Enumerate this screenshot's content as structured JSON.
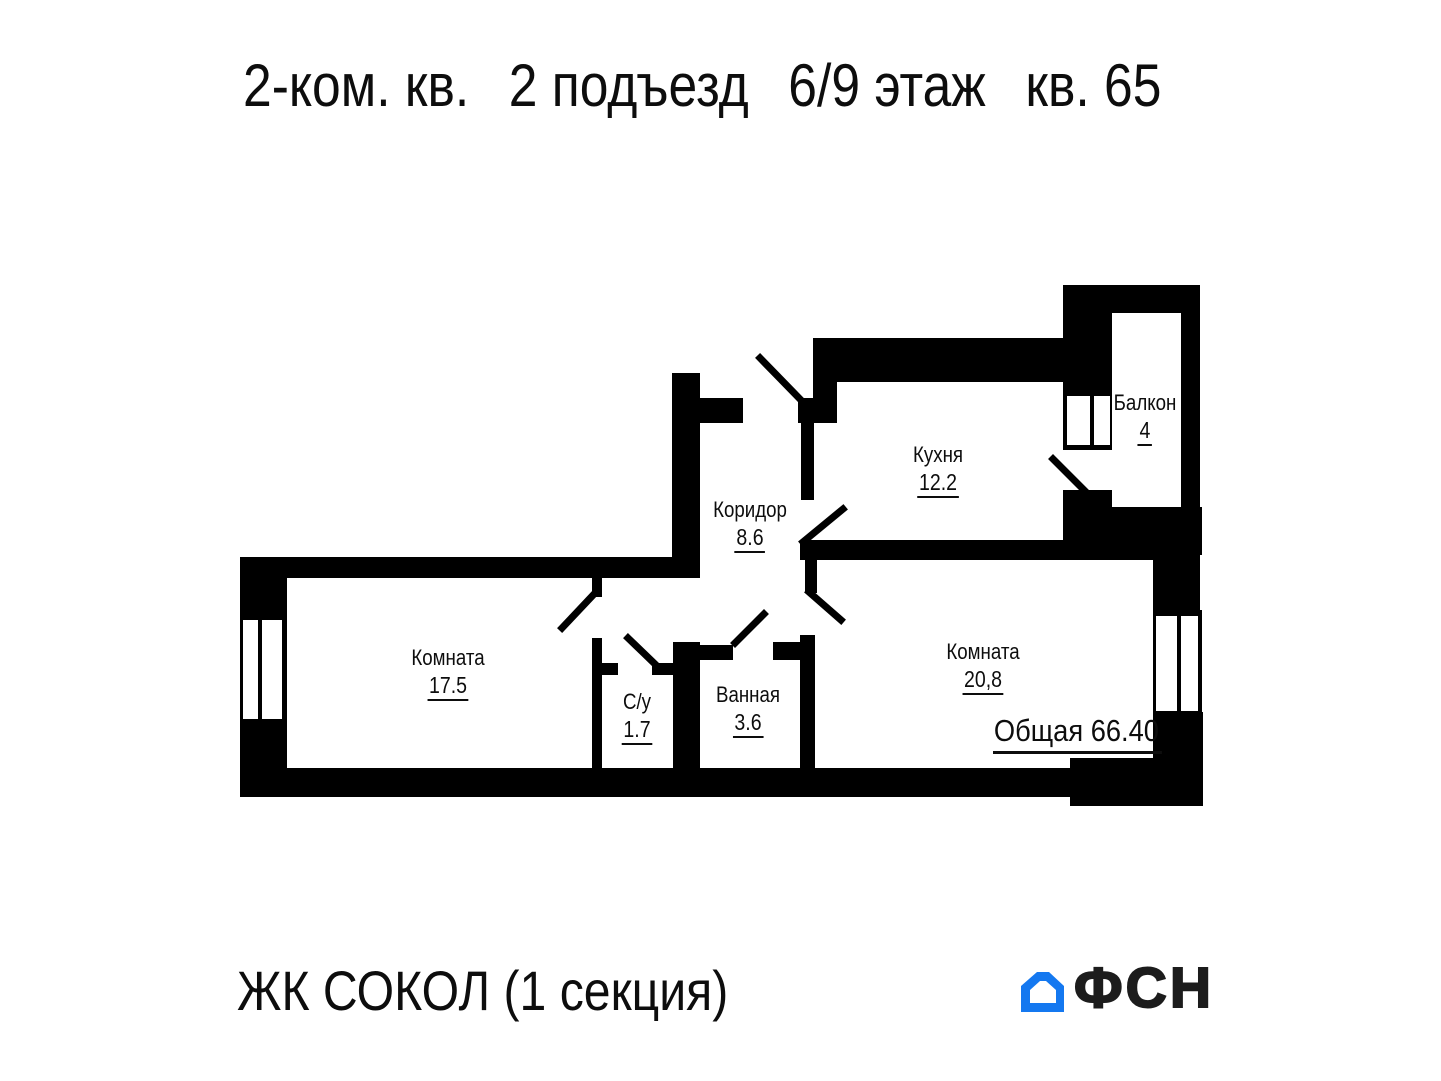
{
  "title": {
    "parts": [
      "2-ком. кв.",
      "2 подъезд",
      "6/9 этаж",
      "кв. 65"
    ]
  },
  "plan": {
    "rooms": [
      {
        "name": "Кухня",
        "area": "12.2"
      },
      {
        "name": "Балкон",
        "area": "4"
      },
      {
        "name": "Коридор",
        "area": "8.6"
      },
      {
        "name": "Комната",
        "area": "17.5"
      },
      {
        "name": "С/у",
        "area": "1.7"
      },
      {
        "name": "Ванная",
        "area": "3.6"
      },
      {
        "name": "Комната",
        "area": "20,8"
      }
    ],
    "total_label": "Общая",
    "total_value": "66.40"
  },
  "footer": {
    "project_name": "ЖК СОКОЛ (1 секция)",
    "logo_text": "ФСН"
  },
  "colors": {
    "wall": "#000000",
    "logo_blue": "#1478f0",
    "text": "#111111"
  }
}
